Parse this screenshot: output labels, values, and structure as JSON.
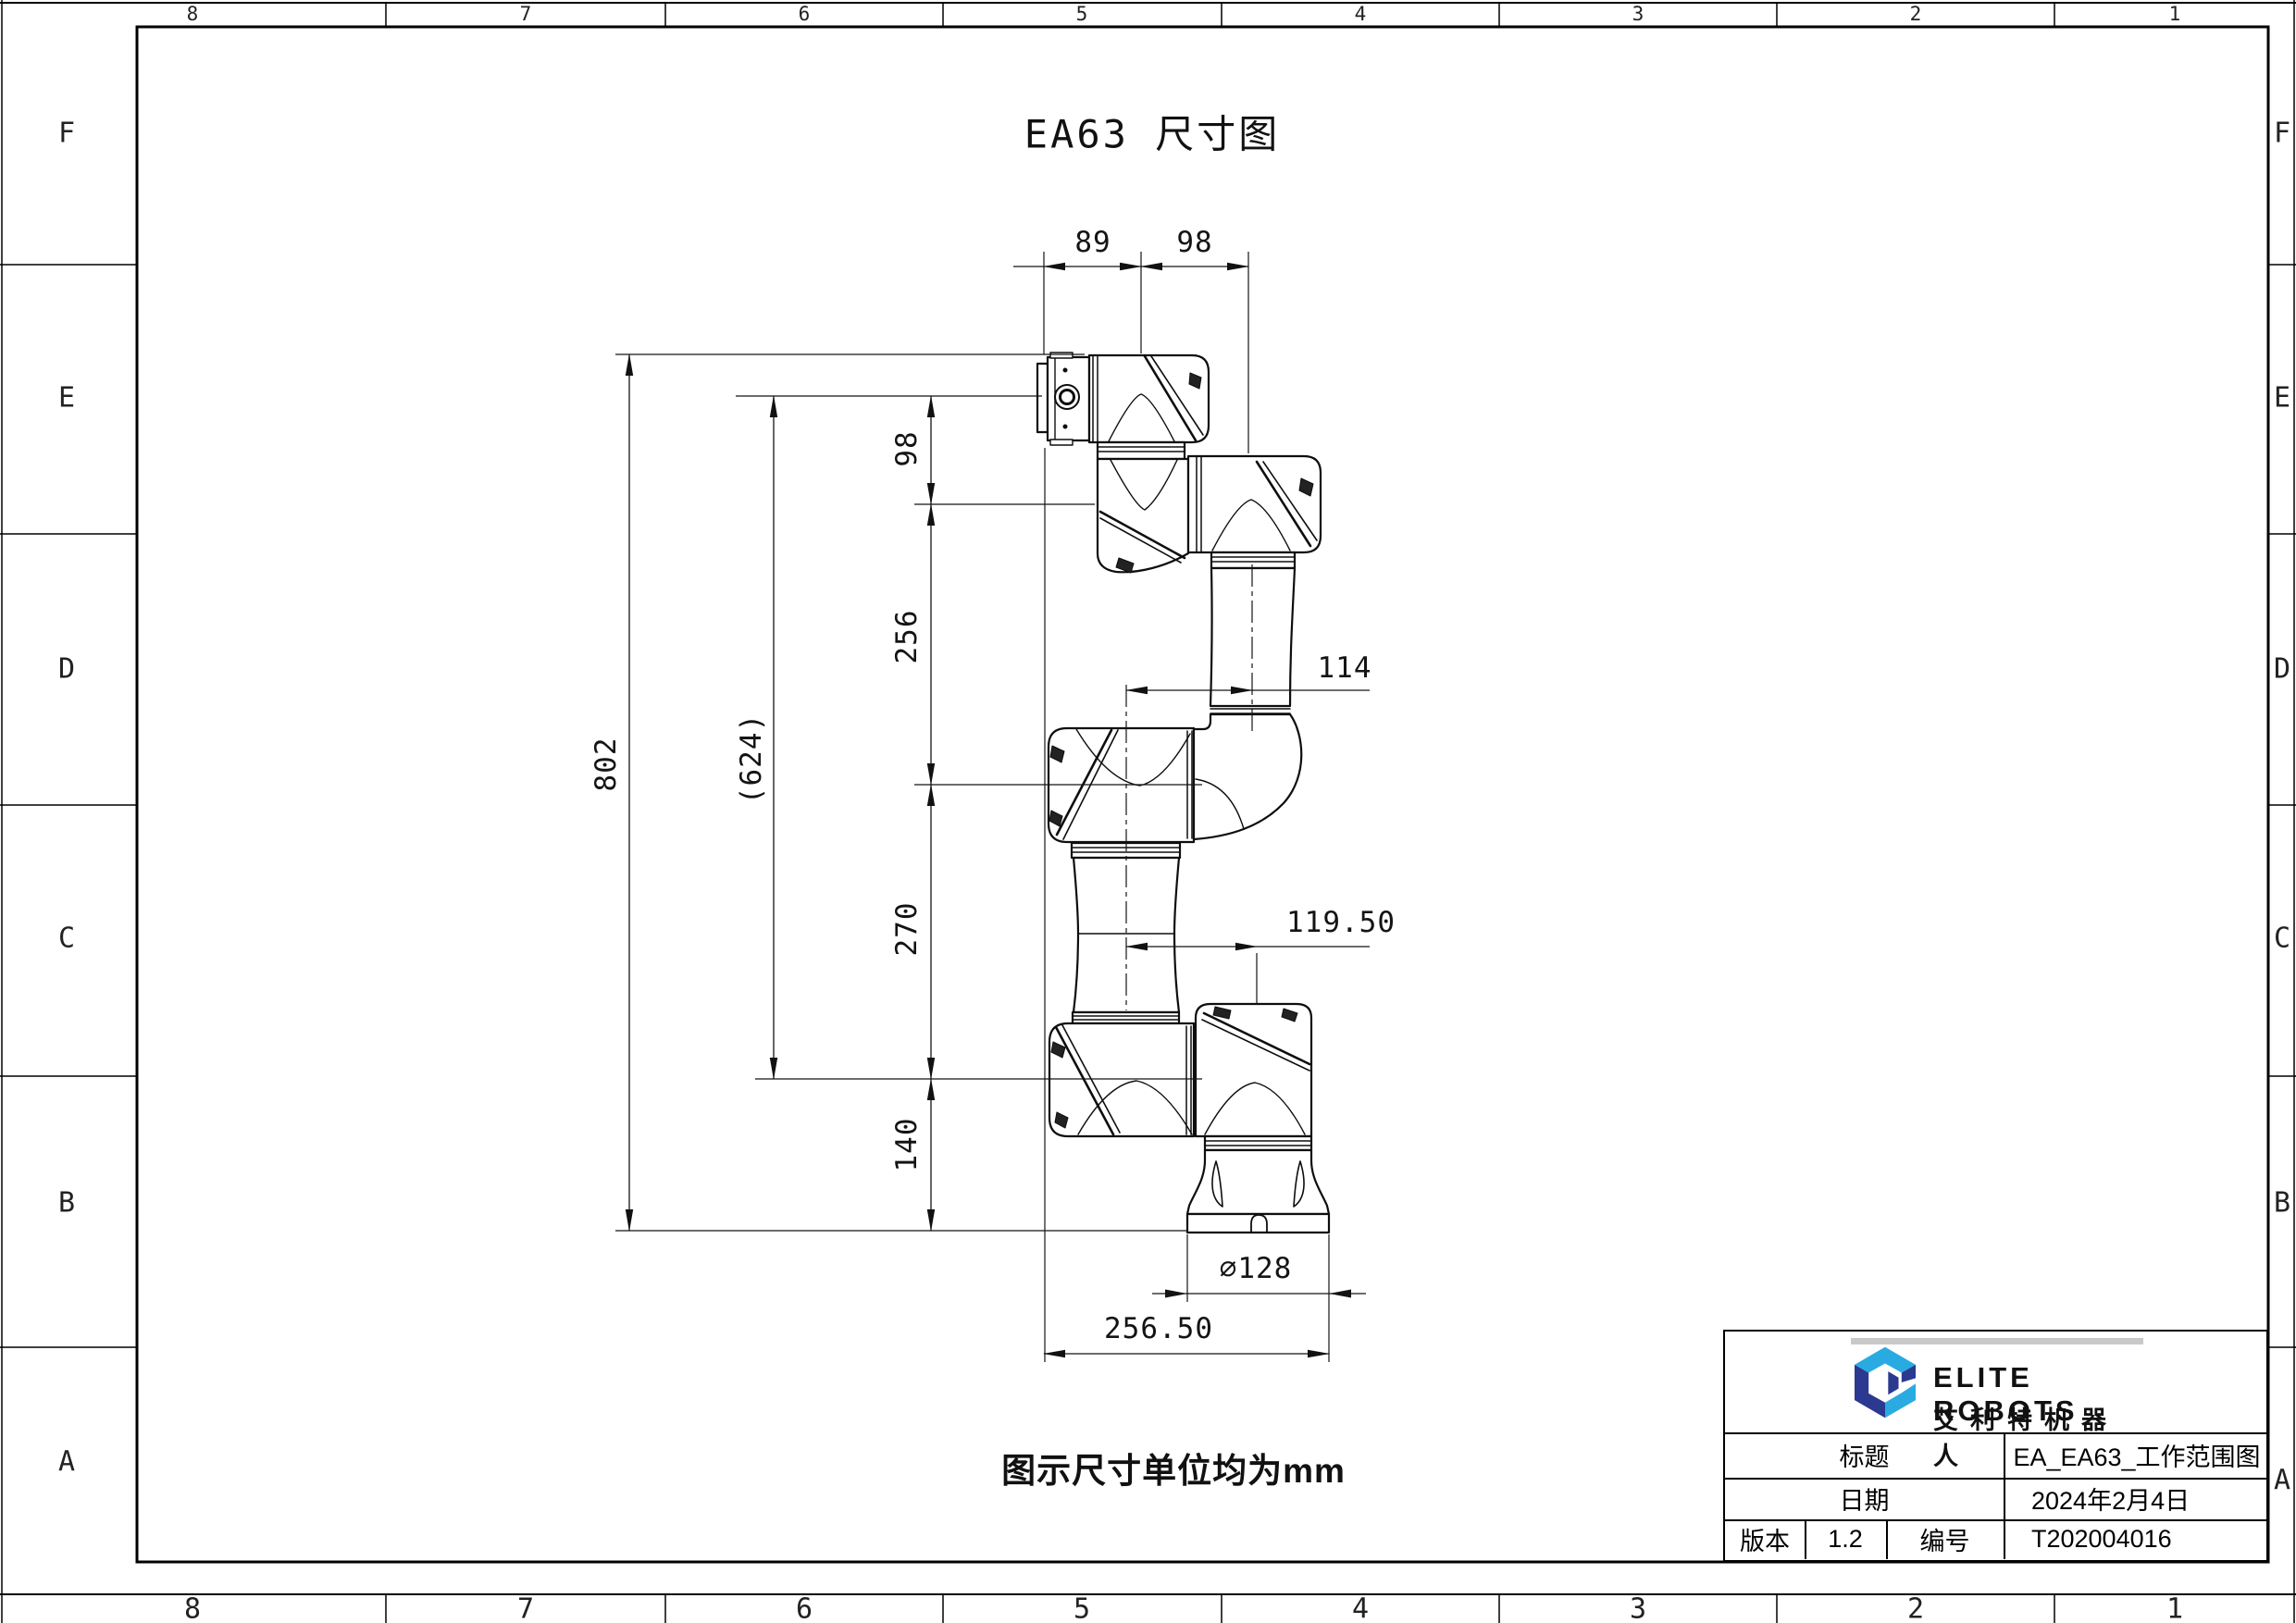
{
  "sheet": {
    "title": "EA63 尺寸图",
    "note": "图示尺寸单位均为mm"
  },
  "frame": {
    "columns": [
      "8",
      "7",
      "6",
      "5",
      "4",
      "3",
      "2",
      "1"
    ],
    "rows": [
      "F",
      "E",
      "D",
      "C",
      "B",
      "A"
    ]
  },
  "dimensions": {
    "top_89": "89",
    "top_98": "98",
    "side_98": "98",
    "side_256": "256",
    "side_270": "270",
    "side_140": "140",
    "overall_802": "802",
    "ref_624": "(624)",
    "mid_114": "114",
    "mid_119_50": "119.50",
    "base_dia": "∅128",
    "base_width": "256.50"
  },
  "title_block": {
    "brand_en": "ELITE ROBOTS",
    "brand_cn": "艾利特机器人",
    "title_label": "标题",
    "title_value": "EA_EA63_工作范围图",
    "date_label": "日期",
    "date_value": "2024年2月4日",
    "version_label": "版本",
    "version_value": "1.2",
    "number_label": "编号",
    "number_value": "T202004016"
  },
  "colors": {
    "line": "#111111",
    "brand_light": "#29abe2",
    "brand_dark": "#2b3990"
  }
}
